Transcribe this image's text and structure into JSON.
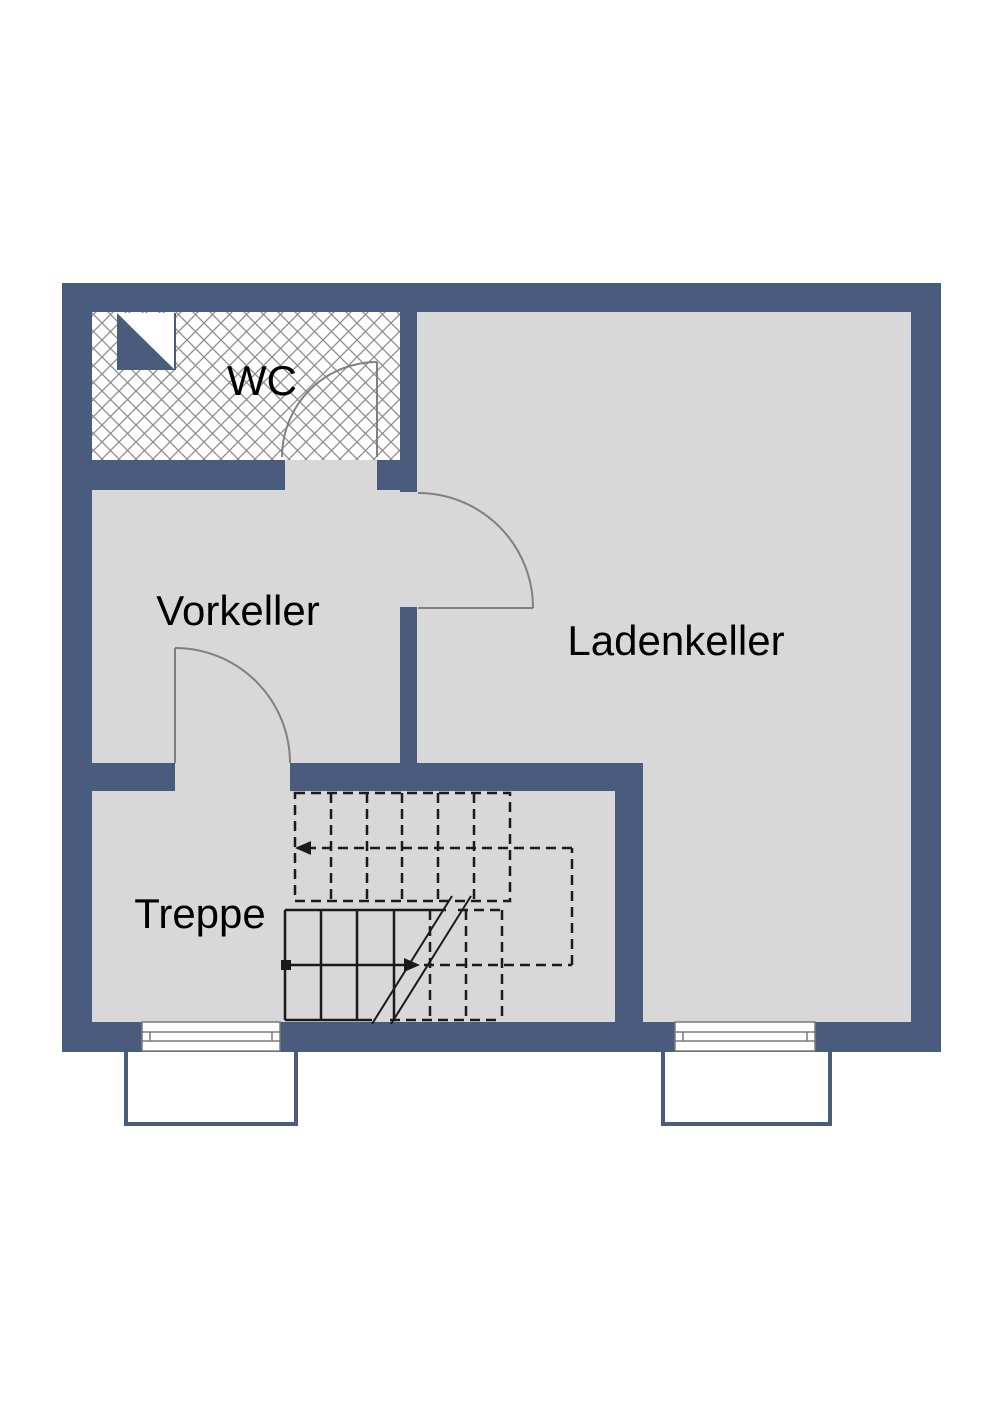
{
  "plan": {
    "kind_visible_hint": "cellar floor plan drawing"
  },
  "rooms": {
    "wc": {
      "label": "WC"
    },
    "vorkeller": {
      "label": "Vorkeller"
    },
    "ladenkeller": {
      "label": "Ladenkeller"
    },
    "treppe": {
      "label": "Treppe"
    }
  },
  "colors": {
    "wall": "#4a5c7e",
    "floor": "#d8d8d8",
    "background": "#ffffff",
    "door_swing": "#808080",
    "stairs": "#1a1a1a",
    "hatch": "#8c8c8c",
    "window_frame": "#7a7a7a",
    "text": "#000000"
  },
  "symbols": {
    "shaft_symbol": "diagonal-split-square",
    "doors": [
      "wc-door",
      "vorkeller-ladenkeller-door",
      "vorkeller-treppe-door"
    ],
    "windows": [
      "window-left",
      "window-right"
    ],
    "light_wells": [
      "light-well-left",
      "light-well-right"
    ],
    "stairs": {
      "flights": 2,
      "upper_flight_style": "dashed (above section cut)",
      "lower_flight_style": "solid with break line",
      "walking_line": "square start marker, two arrows"
    }
  }
}
